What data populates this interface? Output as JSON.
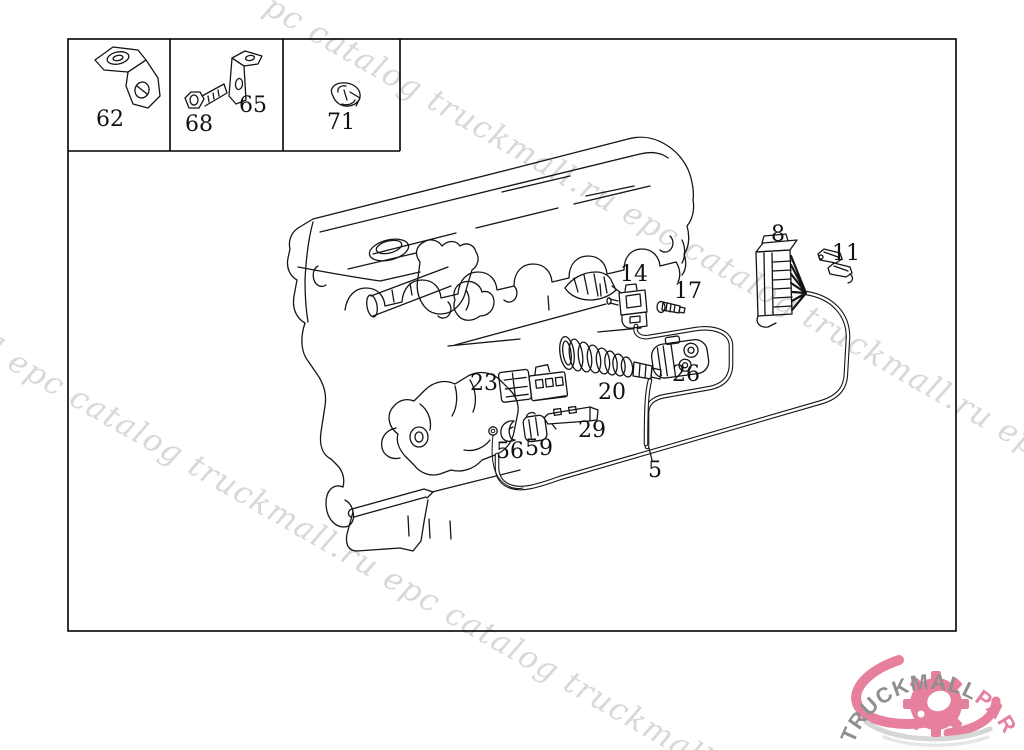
{
  "page": {
    "background": "#ffffff",
    "line_color": "#151515"
  },
  "watermark": {
    "text": "truckmall.ru epc catalog",
    "color": "#d8d8d8",
    "angle_deg": 30,
    "lines": [
      {
        "x": 262,
        "y": 12,
        "text": "pc catalog truckmall.ru epc catalog truckmall.ru epc"
      },
      {
        "x": -14,
        "y": 356,
        "text": "l epc catalog truckmall.ru epc catalog truckmall"
      }
    ]
  },
  "diagram": {
    "inset_labels": [
      "62",
      "68",
      "65",
      "71"
    ],
    "callouts": [
      {
        "label": "62",
        "x": 110,
        "y": 126
      },
      {
        "label": "68",
        "x": 199,
        "y": 131
      },
      {
        "label": "65",
        "x": 253,
        "y": 112
      },
      {
        "label": "71",
        "x": 341,
        "y": 129
      },
      {
        "label": "14",
        "x": 634,
        "y": 281
      },
      {
        "label": "17",
        "x": 688,
        "y": 298
      },
      {
        "label": "8",
        "x": 778,
        "y": 241
      },
      {
        "label": "11",
        "x": 846,
        "y": 260
      },
      {
        "label": "23",
        "x": 484,
        "y": 390
      },
      {
        "label": "20",
        "x": 612,
        "y": 399
      },
      {
        "label": "26",
        "x": 686,
        "y": 381
      },
      {
        "label": "29",
        "x": 592,
        "y": 437
      },
      {
        "label": "56",
        "x": 510,
        "y": 458
      },
      {
        "label": "59",
        "x": 539,
        "y": 455
      },
      {
        "label": "5",
        "x": 655,
        "y": 477
      }
    ]
  },
  "logo": {
    "brand_primary": "TRUCKMALL",
    "brand_secondary": "PARTS",
    "primary_color": "#8f8f8f",
    "secondary_color": "#e57f9d",
    "gear_color": "#e6809d",
    "swoosh_color": "#d6d6d6"
  }
}
